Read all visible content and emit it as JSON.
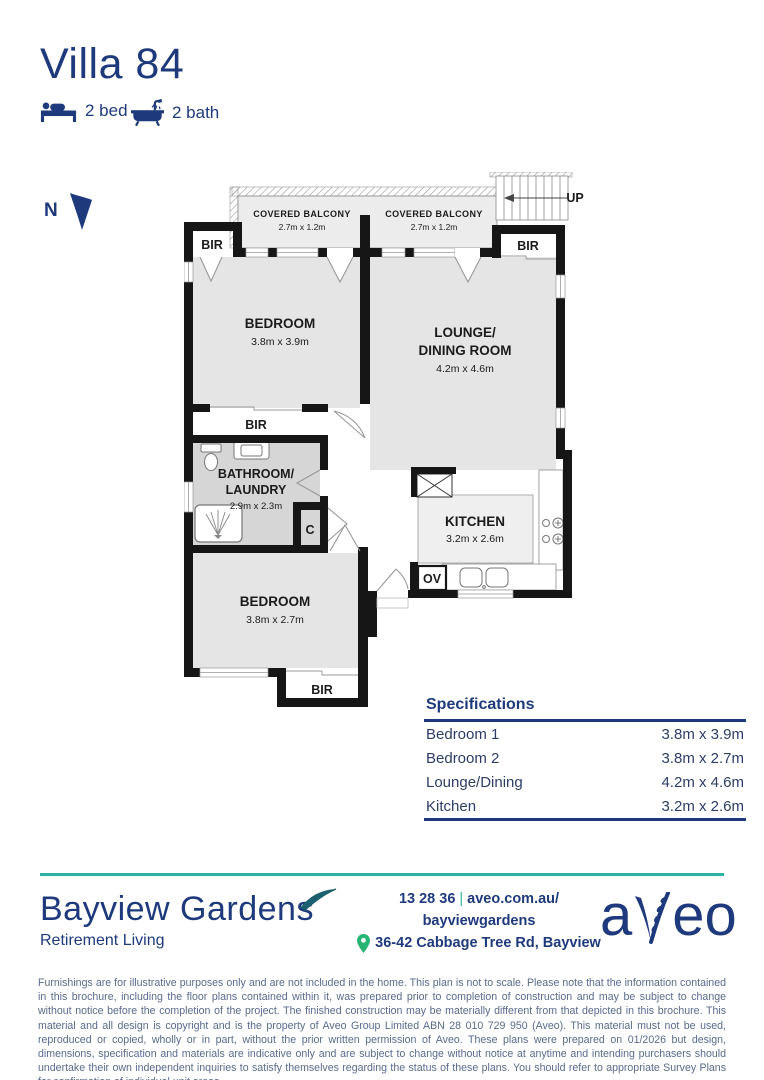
{
  "header": {
    "title": "Villa 84",
    "bed": "2 bed",
    "bath": "2 bath"
  },
  "north": {
    "label": "N"
  },
  "floorplan": {
    "balcony_label": "COVERED BALCONY",
    "balcony_dims": "2.7m x 1.2m",
    "up": "UP",
    "bir": "BIR",
    "cupboard": "C",
    "oven": "OV",
    "bedroom1": {
      "name": "BEDROOM",
      "dims": "3.8m x 3.9m"
    },
    "bedroom2": {
      "name": "BEDROOM",
      "dims": "3.8m x 2.7m"
    },
    "lounge": {
      "name1": "LOUNGE/",
      "name2": "DINING ROOM",
      "dims": "4.2m x 4.6m"
    },
    "bathroom": {
      "name1": "BATHROOM/",
      "name2": "LAUNDRY",
      "dims": "2.9m x 2.3m"
    },
    "kitchen": {
      "name": "KITCHEN",
      "dims": "3.2m x 2.6m"
    }
  },
  "specifications": {
    "heading": "Specifications",
    "rows": [
      {
        "label": "Bedroom 1",
        "value": "3.8m x 3.9m"
      },
      {
        "label": "Bedroom 2",
        "value": "3.8m x 2.7m"
      },
      {
        "label": "Lounge/Dining",
        "value": "4.2m x 4.6m"
      },
      {
        "label": "Kitchen",
        "value": "3.2m x 2.6m"
      }
    ]
  },
  "footer": {
    "brand": "Bayview Gardens",
    "tagline": "Retirement Living",
    "phone": "13 28 36",
    "separator": "|",
    "url_line1": "aveo.com.au/",
    "url_line2": "bayviewgardens",
    "address": "36-42 Cabbage Tree Rd, Bayview",
    "logo_a": "a",
    "logo_eo": "eo"
  },
  "disclaimer": "Furnishings are for illustrative purposes only and are not included in the home. This plan is not to scale. Please note that the information contained in this brochure, including the floor plans contained within it, was prepared prior to completion of construction and may be subject to change without notice before the completion of the project. The finished construction may be materially different from that depicted in this brochure. This material and all design is copyright and is the property of Aveo Group Limited ABN 28 010 729 950 (Aveo). This material must not be used, reproduced or copied, wholly or in part, without the prior written permission of Aveo. These plans were prepared on 01/2026 but design, dimensions, specification and materials are indicative only and are subject to change without notice at anytime and intending purchasers should undertake their own independent inquiries to satisfy themselves regarding the status of these plans. You should refer to appropriate Survey Plans for confirmation of individual unit areas.",
  "colors": {
    "navy": "#1e3a7c",
    "teal": "#2fb3a3",
    "green": "#26b573",
    "wall": "#161616"
  }
}
